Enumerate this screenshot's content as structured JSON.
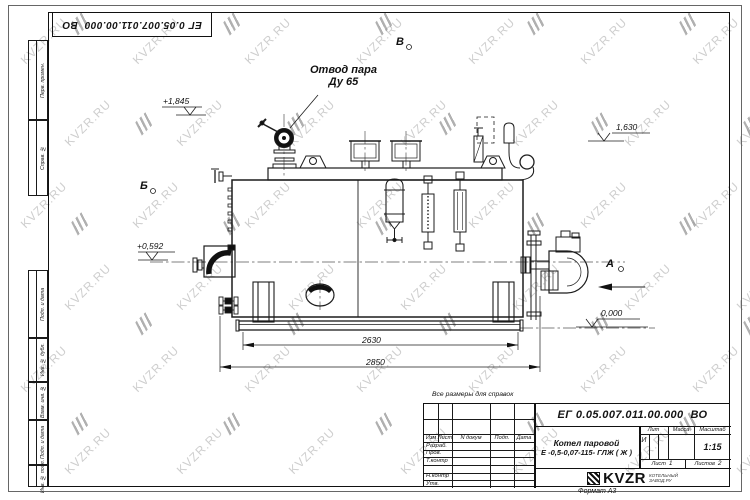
{
  "sheet": {
    "stamp_text": "ЕГ 0.05.007.011.00.000  ВО",
    "format_note": "Формат А3",
    "margin_labels": {
      "perv": "Перв. примен.",
      "sprav": "Справ. №",
      "podp1": "Подп. и дата",
      "inv_dubl": "Инв. № дубл.",
      "vzam": "Взам. инв. №",
      "podp2": "Подп. и дата",
      "inv_podl": "Инв. № подл."
    }
  },
  "drawing": {
    "callout_line1": "Отвод пара",
    "callout_line2": "Ду 65",
    "views": {
      "top": "В",
      "left": "Б",
      "right": "А"
    },
    "elevations": {
      "valve": "+1,845",
      "platform": "1,630",
      "burner": "+0,592",
      "base": "0,000"
    },
    "dimensions": {
      "inner": "2630",
      "outer": "2850"
    },
    "note": "Все размеры для справок"
  },
  "title_block": {
    "designation": "ЕГ 0.05.007.011.00.000  ВО",
    "product_name_line1": "Котел паровой",
    "product_name_line2": "Е -0,5-0,07-115- ГЛЖ ( Ж )",
    "change_header": {
      "izm": "Изм",
      "list": "Лист",
      "doc": "N докум",
      "podp": "Подп.",
      "data": "Дата"
    },
    "sign_rows": [
      {
        "label": "Разраб."
      },
      {
        "label": "Пров."
      },
      {
        "label": "Т.контр"
      },
      {
        "label": ""
      },
      {
        "label": "Н.контр"
      },
      {
        "label": "Утв."
      }
    ],
    "lit_label": "Лит",
    "mass_label": "Масса",
    "scale_label": "Масштаб",
    "lit_value": "И",
    "scale_value": "1:15",
    "sheet_label": "Лист",
    "sheet_number": "1",
    "sheets_label": "Листов",
    "sheets_total": "2",
    "logo": {
      "name": "KVZR",
      "sub_line1": "КОТЕЛЬНЫЙ",
      "sub_line2": "ЗАВОД.РУ"
    }
  },
  "watermark": {
    "text": "KVZR.RU",
    "color": "#c6c6c6"
  }
}
